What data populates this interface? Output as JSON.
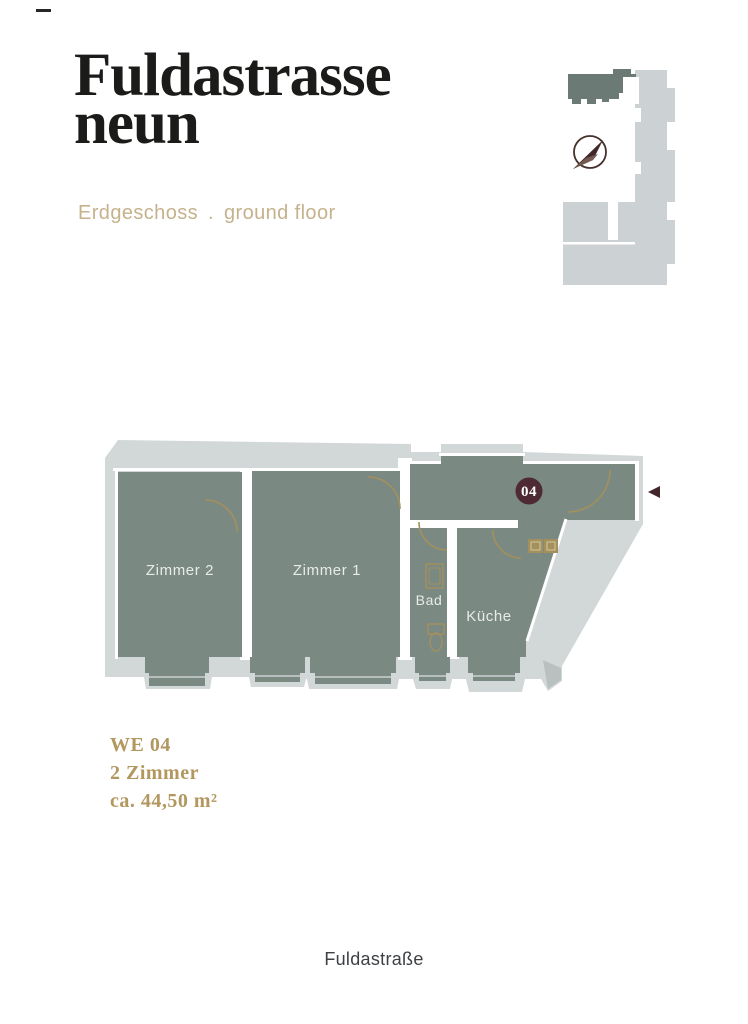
{
  "header": {
    "title_line1": "Fuldastrasse",
    "title_line2": "neun",
    "floor_label_de": "Erdgeschoss",
    "floor_separator": ".",
    "floor_label_en": "ground floor"
  },
  "icons": {
    "compass": "compass-north-arrow-icon",
    "entrance_arrow": "entrance-left-arrow-icon",
    "corner_dash": "page-dash-marker"
  },
  "floor_plan": {
    "rooms": [
      {
        "label": "Zimmer 2"
      },
      {
        "label": "Zimmer 1"
      },
      {
        "label": "Bad"
      },
      {
        "label": "Küche"
      }
    ],
    "unit_badge": "04"
  },
  "unit_info": {
    "unit_id": "WE 04",
    "room_count": "2 Zimmer",
    "area": "ca. 44,50 m²"
  },
  "street_label": "Fuldastraße",
  "colors": {
    "title_black": "#1b1b19",
    "subtitle_gold": "#c5b28c",
    "info_gold": "#b2975f",
    "room_fill": "#7b8983",
    "wall_light": "#d2d7d8",
    "interior_wall_white": "#ffffff",
    "door_gold": "#a3905c",
    "room_label_light": "#e7ebe9",
    "badge_maroon": "#4e2a34",
    "arrow_maroon": "#42262c",
    "street_text": "#3d4145",
    "minimap_light": "#ccd2d3",
    "minimap_unit_dark": "#6c7a75",
    "compass_dark": "#45302b"
  }
}
